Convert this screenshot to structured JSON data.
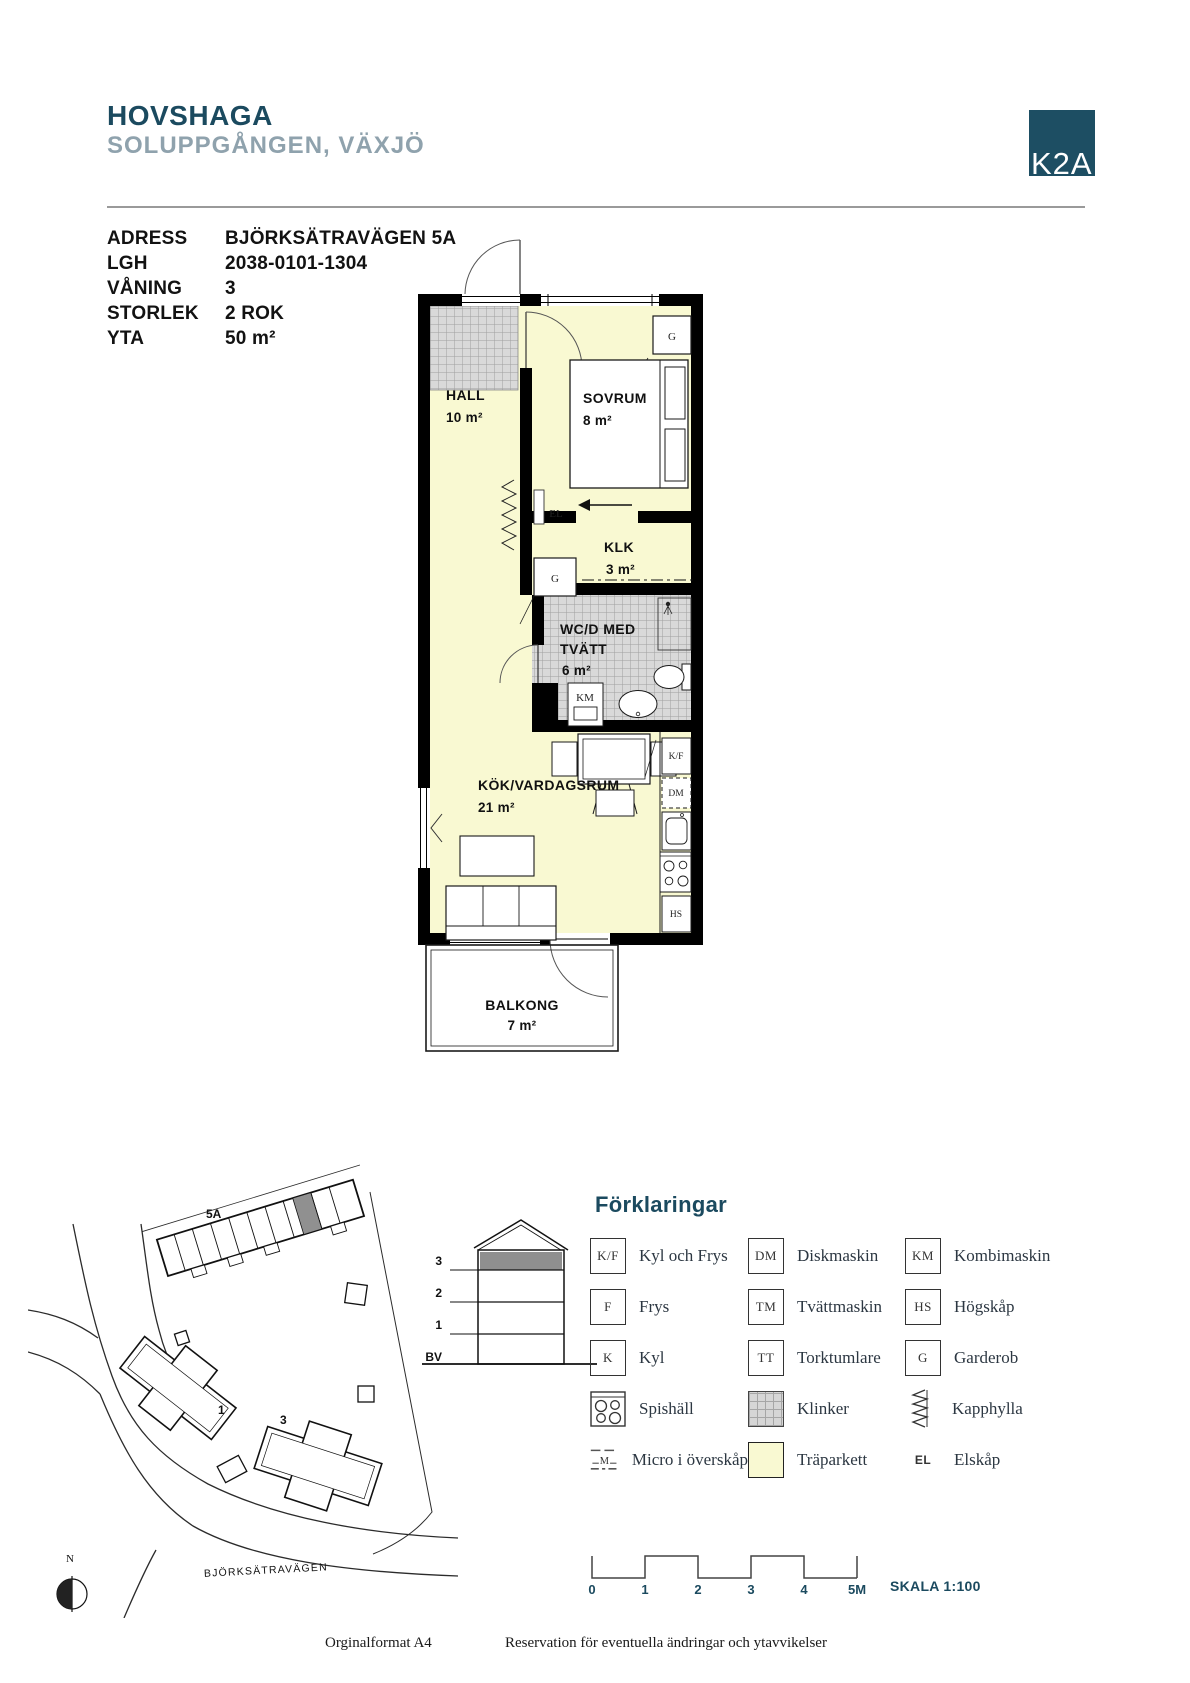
{
  "header": {
    "project": "HOVSHAGA",
    "subtitle": "SOLUPPGÅNGEN, VÄXJÖ",
    "logo": "K2A"
  },
  "info": {
    "rows": [
      {
        "label": "ADRESS",
        "value": "BJÖRKSÄTRAVÄGEN 5A"
      },
      {
        "label": "LGH",
        "value": "2038-0101-1304"
      },
      {
        "label": "VÅNING",
        "value": "3"
      },
      {
        "label": "STORLEK",
        "value": "2 ROK"
      },
      {
        "label": "YTA",
        "value": "50 m²"
      }
    ]
  },
  "floorplan": {
    "rooms": {
      "hall": {
        "name": "HALL",
        "area": "10 m²"
      },
      "sovrum": {
        "name": "SOVRUM",
        "area": "8 m²"
      },
      "klk": {
        "name": "KLK",
        "area": "3 m²"
      },
      "wc": {
        "name_line1": "WC/D MED",
        "name_line2": "TVÄTT",
        "area": "6 m²"
      },
      "kok": {
        "name": "KÖK/VARDAGSRUM",
        "area": "21 m²"
      },
      "balkong": {
        "name": "BALKONG",
        "area": "7 m²"
      }
    },
    "markers": {
      "garderob": "G",
      "el": "EL",
      "kombimaskin": "KM",
      "kyl_frys": "K/F",
      "diskmaskin": "DM",
      "hogskap": "HS"
    }
  },
  "siteplan": {
    "building_label": "5A",
    "house1_label": "1",
    "house3_label": "3",
    "road_label": "BJÖRKSÄTRAVÄGEN",
    "compass_label": "N"
  },
  "section": {
    "floors": [
      "3",
      "2",
      "1",
      "BV"
    ]
  },
  "legend": {
    "title": "Förklaringar",
    "items": [
      {
        "code": "K/F",
        "label": "Kyl och Frys"
      },
      {
        "code": "DM",
        "label": "Diskmaskin"
      },
      {
        "code": "KM",
        "label": "Kombimaskin"
      },
      {
        "code": "F",
        "label": "Frys"
      },
      {
        "code": "TM",
        "label": "Tvättmaskin"
      },
      {
        "code": "HS",
        "label": "Högskåp"
      },
      {
        "code": "K",
        "label": "Kyl"
      },
      {
        "code": "TT",
        "label": "Torktumlare"
      },
      {
        "code": "G",
        "label": "Garderob"
      },
      {
        "code": "",
        "label": "Spishäll"
      },
      {
        "code": "",
        "label": "Klinker"
      },
      {
        "code": "",
        "label": "Kapphylla"
      },
      {
        "code": "M",
        "label": "Micro i överskåp"
      },
      {
        "code": "",
        "label": "Träparkett"
      },
      {
        "code": "EL",
        "label": "Elskåp"
      }
    ]
  },
  "scalebar": {
    "ticks": [
      "0",
      "1",
      "2",
      "3",
      "4",
      "5M"
    ],
    "scale_label": "SKALA 1:100"
  },
  "footer": {
    "left": "Orginalformat A4",
    "right": "Reservation för eventuella ändringar och ytavvikelser"
  }
}
